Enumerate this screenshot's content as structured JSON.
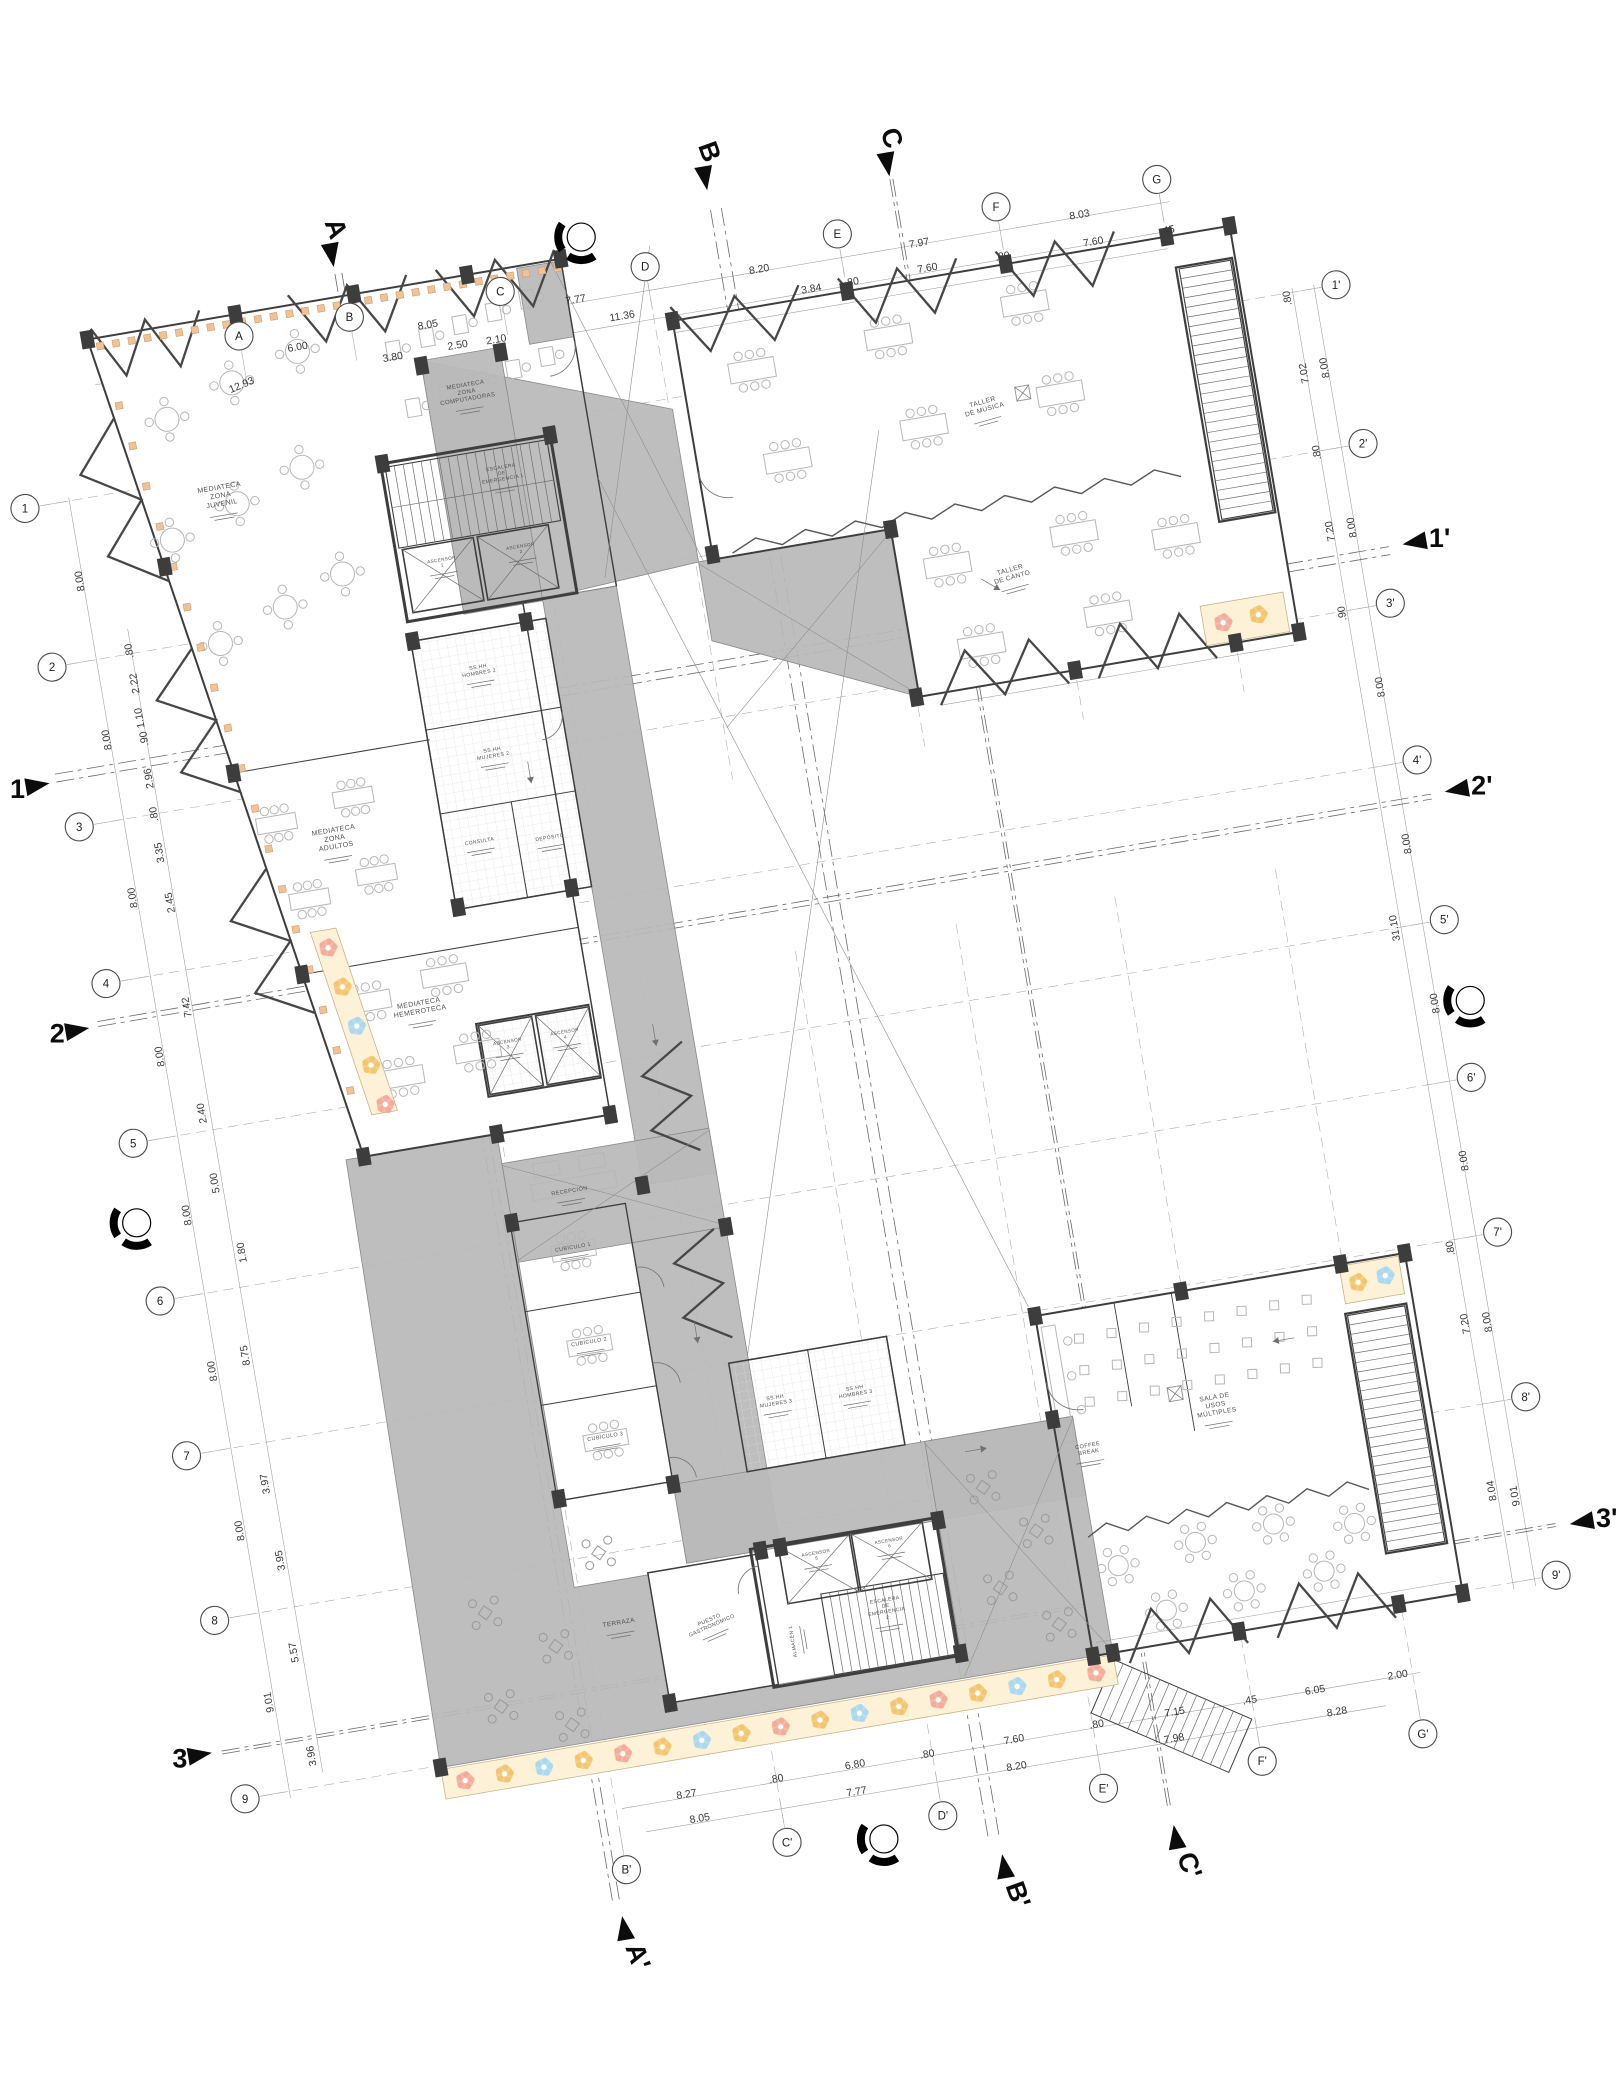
{
  "drawing": {
    "type": "architectural-floor-plan",
    "language": "es",
    "colors": {
      "paper": "#ffffff",
      "corridor_gray": "#b9b9b9",
      "wall": "#3e3e3e",
      "mosaic_cream": "#fdf2d7",
      "mosaic_pink": "#f2a899",
      "mosaic_orange": "#f3c36d",
      "mosaic_blue": "#a6d7f2",
      "facade_orange": "#eec39a"
    }
  },
  "plan": {
    "rotation_deg": -9.68,
    "origin": {
      "x": 239,
      "y": 336
    },
    "grid": {
      "offsets": {
        "top_v": 0,
        "bottom_v": 1577,
        "left_u": -240,
        "right_u": 1090
      },
      "top_cols": [
        {
          "id": "A",
          "u": 0
        },
        {
          "id": "B",
          "u": 112
        },
        {
          "id": "C",
          "u": 265
        },
        {
          "id": "D",
          "u": 412
        },
        {
          "id": "E",
          "u": 607
        },
        {
          "id": "F",
          "u": 768
        },
        {
          "id": "G",
          "u": 931
        }
      ],
      "bottom_cols": [
        {
          "id": "B'",
          "u": 124
        },
        {
          "id": "C'",
          "u": 287
        },
        {
          "id": "D'",
          "u": 445
        },
        {
          "id": "E'",
          "u": 608
        },
        {
          "id": "F'",
          "u": 769
        },
        {
          "id": "G'",
          "u": 932
        }
      ],
      "left_rows": [
        {
          "id": "1",
          "v": 134
        },
        {
          "id": "2",
          "v": 295
        },
        {
          "id": "3",
          "v": 457
        },
        {
          "id": "4",
          "v": 616
        },
        {
          "id": "5",
          "v": 778
        },
        {
          "id": "6",
          "v": 938
        },
        {
          "id": "7",
          "v": 1095
        },
        {
          "id": "8",
          "v": 1262
        },
        {
          "id": "9",
          "v": 1443
        }
      ],
      "right_rows": [
        {
          "id": "1'",
          "v": 134
        },
        {
          "id": "2'",
          "v": 295
        },
        {
          "id": "3'",
          "v": 457
        },
        {
          "id": "4'",
          "v": 616
        },
        {
          "id": "5'",
          "v": 778
        },
        {
          "id": "6'",
          "v": 938
        },
        {
          "id": "7'",
          "v": 1095
        },
        {
          "id": "8'",
          "v": 1262
        },
        {
          "id": "9'",
          "v": 1443
        }
      ]
    },
    "dims": {
      "top": [
        {
          "t": "12.93",
          "u": -5,
          "v": 52,
          "r": -13
        },
        {
          "t": "6.00",
          "u": 56,
          "v": 24
        },
        {
          "t": "8.05",
          "u": 188,
          "v": 24
        },
        {
          "t": "7.77",
          "u": 338,
          "v": 24
        },
        {
          "t": "8.20",
          "u": 524,
          "v": 25
        },
        {
          "t": "7.97",
          "u": 686,
          "v": 26
        },
        {
          "t": "8.03",
          "u": 849,
          "v": 25
        },
        {
          "t": "3.80",
          "u": 148,
          "v": 50
        },
        {
          "t": "2.50",
          "u": 214,
          "v": 49
        },
        {
          "t": "2.10",
          "u": 253,
          "v": 50
        },
        {
          "t": "11.36",
          "u": 381,
          "v": 48
        },
        {
          "t": "3.84",
          "u": 572,
          "v": 53
        },
        {
          "t": ".80",
          "u": 613,
          "v": 53
        },
        {
          "t": "7.60",
          "u": 690,
          "v": 52
        },
        {
          "t": ".80",
          "u": 766,
          "v": 53
        },
        {
          "t": "7.60",
          "u": 858,
          "v": 54
        },
        {
          "t": ".45",
          "u": 933,
          "v": 55
        }
      ],
      "left": [
        {
          "t": "8.00",
          "u": -195,
          "v": 215
        },
        {
          "t": "8.00",
          "u": -195,
          "v": 376
        },
        {
          "t": "8.00",
          "u": -196,
          "v": 536
        },
        {
          "t": "8.00",
          "u": -196,
          "v": 697
        },
        {
          "t": "8.00",
          "u": -196,
          "v": 858
        },
        {
          "t": "8.00",
          "u": -197,
          "v": 1016
        },
        {
          "t": "8.00",
          "u": -197,
          "v": 1178
        },
        {
          "t": "9.01",
          "u": -197,
          "v": 1352
        },
        {
          "t": ".80",
          "u": -158,
          "v": 292
        },
        {
          "t": "2.22",
          "u": -158,
          "v": 325
        },
        {
          "t": "1.10",
          "u": -159,
          "v": 360
        },
        {
          "t": ".90",
          "u": -158,
          "v": 381
        },
        {
          "t": "2.96",
          "u": -160,
          "v": 421
        },
        {
          "t": ".80",
          "u": -161,
          "v": 457
        },
        {
          "t": "3.35",
          "u": -162,
          "v": 496
        },
        {
          "t": "2.45",
          "u": -160,
          "v": 547
        },
        {
          "t": "7.42",
          "u": -161,
          "v": 653
        },
        {
          "t": "2.40",
          "u": -164,
          "v": 760
        },
        {
          "t": "5.00",
          "u": -163,
          "v": 831
        },
        {
          "t": "1.80",
          "u": -148,
          "v": 904
        },
        {
          "t": "8.75",
          "u": -162,
          "v": 1006
        },
        {
          "t": "3.97",
          "u": -164,
          "v": 1136
        },
        {
          "t": "3.95",
          "u": -162,
          "v": 1214
        },
        {
          "t": "5.57",
          "u": -164,
          "v": 1307
        },
        {
          "t": "3.96",
          "u": -164,
          "v": 1412
        }
      ],
      "right": [
        {
          "t": "8.00",
          "u": 1068,
          "v": 214
        },
        {
          "t": "8.00",
          "u": 1068,
          "v": 376
        },
        {
          "t": "8.00",
          "u": 1069,
          "v": 538
        },
        {
          "t": "8.00",
          "u": 1069,
          "v": 697
        },
        {
          "t": "8.00",
          "u": 1070,
          "v": 859
        },
        {
          "t": "8.00",
          "u": 1072,
          "v": 1019
        },
        {
          "t": "8.00",
          "u": 1068,
          "v": 1182
        },
        {
          "t": "9.01",
          "u": 1066,
          "v": 1358
        },
        {
          "t": ".80",
          "u": 1043,
          "v": 139
        },
        {
          "t": "7.02",
          "u": 1047,
          "v": 216
        },
        {
          "t": ".80",
          "u": 1046,
          "v": 296
        },
        {
          "t": "7.20",
          "u": 1046,
          "v": 376
        },
        {
          "t": ".90",
          "u": 1044,
          "v": 459
        },
        {
          "t": "31.10",
          "u": 1043,
          "v": 778
        },
        {
          "t": ".80",
          "u": 1044,
          "v": 1103
        },
        {
          "t": "7.20",
          "u": 1046,
          "v": 1180
        },
        {
          "t": "8.04",
          "u": 1044,
          "v": 1349
        }
      ],
      "bottom": [
        {
          "t": "8.27",
          "u": 196,
          "v": 1516
        },
        {
          "t": ".80",
          "u": 287,
          "v": 1516
        },
        {
          "t": "6.80",
          "u": 367,
          "v": 1515
        },
        {
          "t": ".80",
          "u": 440,
          "v": 1517
        },
        {
          "t": "7.60",
          "u": 528,
          "v": 1517
        },
        {
          "t": ".80",
          "u": 612,
          "v": 1516
        },
        {
          "t": "7.15",
          "u": 691,
          "v": 1517
        },
        {
          "t": ".45",
          "u": 767,
          "v": 1518
        },
        {
          "t": "6.05",
          "u": 833,
          "v": 1519
        },
        {
          "t": "2.00",
          "u": 917,
          "v": 1518
        },
        {
          "t": "8.05",
          "u": 205,
          "v": 1542
        },
        {
          "t": "7.77",
          "u": 364,
          "v": 1542
        },
        {
          "t": "8.20",
          "u": 526,
          "v": 1544
        },
        {
          "t": "7.98",
          "u": 686,
          "v": 1543
        },
        {
          "t": "8.28",
          "u": 851,
          "v": 1544
        }
      ]
    },
    "sections": [
      {
        "label": "A",
        "u": 105,
        "v": -62,
        "side": "top"
      },
      {
        "label": "B",
        "u": 486,
        "v": -75,
        "side": "top"
      },
      {
        "label": "C",
        "u": 668,
        "v": -58,
        "side": "top"
      },
      {
        "label": "A'",
        "u": 112,
        "v": 1632,
        "side": "bottom"
      },
      {
        "label": "B'",
        "u": 497,
        "v": 1635,
        "side": "bottom"
      },
      {
        "label": "C'",
        "u": 671,
        "v": 1635,
        "side": "bottom"
      },
      {
        "label": "1",
        "u": -272,
        "v": 409,
        "side": "left"
      },
      {
        "label": "2",
        "u": -274,
        "v": 657,
        "side": "left"
      },
      {
        "label": "3",
        "u": -275,
        "v": 1392,
        "side": "left"
      },
      {
        "label": "1'",
        "u": 1122,
        "v": 401,
        "side": "right"
      },
      {
        "label": "2'",
        "u": 1122,
        "v": 652,
        "side": "right"
      },
      {
        "label": "3'",
        "u": 1122,
        "v": 1395,
        "side": "right"
      }
    ],
    "benchmarks": [
      {
        "u": 354,
        "v": -40
      },
      {
        "u": 1102,
        "v": 862
      },
      {
        "u": -250,
        "v": 857
      },
      {
        "u": 383,
        "v": 1590
      }
    ],
    "rooms": [
      {
        "t": "MEDIATECA\nZONA\nJUVENIL",
        "u": -45,
        "v": 148,
        "s": 7
      },
      {
        "t": "MEDIATECA\nZONA\nCOMPUTADORAS",
        "u": 215,
        "v": 88,
        "s": 6
      },
      {
        "t": "MEDIATECA\nZONA\nADULTOS",
        "u": 10,
        "v": 505,
        "s": 7
      },
      {
        "t": "MEDIATECA\nHEMEROTECA",
        "u": 65,
        "v": 690,
        "s": 7
      },
      {
        "t": "ESCALERA\nDE\nEMERGENCIA 1",
        "u": 236,
        "v": 175,
        "s": 5
      },
      {
        "t": "ASCENSOR\n1",
        "u": 162,
        "v": 256,
        "s": 4.6
      },
      {
        "t": "ASCENSOR\n2",
        "u": 242,
        "v": 256,
        "s": 4.6
      },
      {
        "t": "SS.HH\nHOMBRES 2",
        "u": 180,
        "v": 368,
        "s": 5.2
      },
      {
        "t": "SS.HH\nMUJERES 2",
        "u": 180,
        "v": 452,
        "s": 5.2
      },
      {
        "t": "CONSULTA",
        "u": 152,
        "v": 540,
        "s": 5
      },
      {
        "t": "DEPÓSITO",
        "u": 222,
        "v": 548,
        "s": 5
      },
      {
        "t": "ASCENSOR\n3",
        "u": 146,
        "v": 742,
        "s": 4.6
      },
      {
        "t": "ASCENSOR\n4",
        "u": 204,
        "v": 742,
        "s": 4.6
      },
      {
        "t": "RECEPCIÓN",
        "u": 182,
        "v": 900,
        "s": 5.6
      },
      {
        "t": "CUBÍCULO 1",
        "u": 176,
        "v": 956,
        "s": 5.4
      },
      {
        "t": "CUBÍCULO 2",
        "u": 176,
        "v": 1052,
        "s": 5.4
      },
      {
        "t": "CUBÍCULO 3",
        "u": 176,
        "v": 1148,
        "s": 5.4
      },
      {
        "t": "SS.HH\nMUJERES 3",
        "u": 350,
        "v": 1138,
        "s": 5.2
      },
      {
        "t": "SS.HH\nHOMBRES 3",
        "u": 430,
        "v": 1142,
        "s": 5.2
      },
      {
        "t": "ASCENSOR\n5",
        "u": 364,
        "v": 1298,
        "s": 4.6
      },
      {
        "t": "ASCENSOR\n6",
        "u": 438,
        "v": 1298,
        "s": 4.6
      },
      {
        "t": "ALMACÉN 1",
        "u": 328,
        "v": 1380,
        "s": 5,
        "r": -90
      },
      {
        "t": "ESCALERA\nDE\nEMERGENCIA\n2",
        "u": 424,
        "v": 1356,
        "s": 5
      },
      {
        "t": "PUESTO\nGASTRONÓMICO",
        "u": 248,
        "v": 1346,
        "s": 5.4,
        "r": -14
      },
      {
        "t": "TERRAZA",
        "u": 158,
        "v": 1334,
        "s": 6.4
      },
      {
        "t": "SALA DE\nUSOS\nMÚLTIPLES",
        "u": 783,
        "v": 1212,
        "s": 6.6
      },
      {
        "t": "COFFEE\nBREAK",
        "u": 650,
        "v": 1238,
        "s": 5.6
      },
      {
        "t": "TALLER\nDE MÚSICA",
        "u": 722,
        "v": 192,
        "s": 6.6,
        "r": -6
      },
      {
        "t": "TALLER\nDE CANTO",
        "u": 721,
        "v": 362,
        "s": 6.6,
        "r": -6
      }
    ]
  }
}
